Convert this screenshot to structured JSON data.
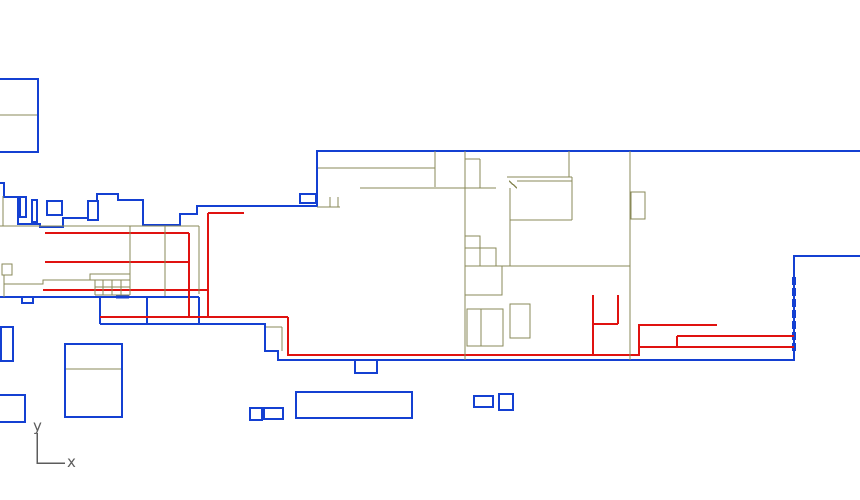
{
  "canvas": {
    "width": 860,
    "height": 500,
    "background": "#ffffff"
  },
  "colors": {
    "blue": "#1440d2",
    "red": "#e01210",
    "olive": "#8a8a58",
    "axis": "#5c5c5c"
  },
  "axis_indicator": {
    "y_label": "y",
    "x_label": "x",
    "origin": [
      37,
      463
    ],
    "y_top": 433,
    "x_right": 65
  },
  "stroke_widths": {
    "blue": 1.8,
    "red": 1.6,
    "olive": 1.4,
    "axis": 1.5
  },
  "shapes": [
    {
      "layer": "blue",
      "type": "rect",
      "x": -2,
      "y": 79,
      "w": 40,
      "h": 73
    },
    {
      "layer": "olive",
      "type": "seg",
      "p": [
        0,
        115,
        38,
        115
      ]
    },
    {
      "layer": "blue",
      "type": "poly",
      "pts": [
        [
          0,
          183
        ],
        [
          4,
          183
        ],
        [
          4,
          197
        ],
        [
          18,
          197
        ],
        [
          18,
          224
        ],
        [
          40,
          224
        ],
        [
          40,
          227
        ],
        [
          63,
          227
        ],
        [
          63,
          218
        ],
        [
          88,
          218
        ],
        [
          88,
          201
        ],
        [
          97,
          201
        ],
        [
          97,
          194
        ],
        [
          118,
          194
        ],
        [
          118,
          200
        ],
        [
          143,
          200
        ],
        [
          143,
          225
        ],
        [
          180,
          225
        ],
        [
          180,
          214
        ],
        [
          197,
          214
        ],
        [
          197,
          206
        ],
        [
          317,
          206
        ],
        [
          317,
          151
        ],
        [
          860,
          151
        ]
      ]
    },
    {
      "layer": "blue",
      "type": "rect",
      "x": 20,
      "y": 197,
      "w": 6,
      "h": 20
    },
    {
      "layer": "blue",
      "type": "rect",
      "x": 32,
      "y": 200,
      "w": 5,
      "h": 22
    },
    {
      "layer": "blue",
      "type": "rect",
      "x": 47,
      "y": 201,
      "w": 15,
      "h": 14
    },
    {
      "layer": "blue",
      "type": "rect",
      "x": 88,
      "y": 201,
      "w": 10,
      "h": 19
    },
    {
      "layer": "blue",
      "type": "rect",
      "x": 300,
      "y": 194,
      "w": 16,
      "h": 9
    },
    {
      "layer": "blue",
      "type": "seg",
      "p": [
        0,
        297,
        199,
        297
      ]
    },
    {
      "layer": "blue",
      "type": "seg",
      "p": [
        199,
        297,
        199,
        324
      ]
    },
    {
      "layer": "blue",
      "type": "seg",
      "p": [
        100,
        297,
        100,
        324
      ]
    },
    {
      "layer": "blue",
      "type": "seg",
      "p": [
        147,
        297,
        147,
        324
      ]
    },
    {
      "layer": "blue",
      "type": "poly",
      "pts": [
        [
          100,
          324
        ],
        [
          265,
          324
        ],
        [
          265,
          351
        ],
        [
          278,
          351
        ],
        [
          278,
          360
        ],
        [
          794,
          360
        ],
        [
          794,
          256
        ],
        [
          860,
          256
        ]
      ]
    },
    {
      "layer": "blue",
      "type": "poly",
      "pts": [
        [
          355,
          360
        ],
        [
          355,
          373
        ],
        [
          377,
          373
        ],
        [
          377,
          360
        ]
      ]
    },
    {
      "layer": "blue",
      "type": "poly",
      "pts": [
        [
          22,
          297
        ],
        [
          22,
          303
        ],
        [
          33,
          303
        ],
        [
          33,
          297
        ]
      ]
    },
    {
      "layer": "blue",
      "type": "seg",
      "p": [
        116,
        297,
        129,
        297
      ],
      "w": 3
    },
    {
      "layer": "blue",
      "type": "seg",
      "p": [
        794,
        277,
        794,
        353
      ],
      "w": 4,
      "dash": "8,3"
    },
    {
      "layer": "blue",
      "type": "rect",
      "x": 1,
      "y": 327,
      "w": 12,
      "h": 34
    },
    {
      "layer": "blue",
      "type": "rect",
      "x": 65,
      "y": 344,
      "w": 57,
      "h": 73
    },
    {
      "layer": "olive",
      "type": "seg",
      "p": [
        65,
        369,
        122,
        369
      ]
    },
    {
      "layer": "blue",
      "type": "rect",
      "x": -3,
      "y": 395,
      "w": 28,
      "h": 27
    },
    {
      "layer": "blue",
      "type": "rect",
      "x": 250,
      "y": 408,
      "w": 12,
      "h": 12
    },
    {
      "layer": "blue",
      "type": "rect",
      "x": 264,
      "y": 408,
      "w": 19,
      "h": 11
    },
    {
      "layer": "blue",
      "type": "rect",
      "x": 296,
      "y": 392,
      "w": 116,
      "h": 26
    },
    {
      "layer": "blue",
      "type": "rect",
      "x": 474,
      "y": 396,
      "w": 19,
      "h": 11
    },
    {
      "layer": "blue",
      "type": "rect",
      "x": 499,
      "y": 394,
      "w": 14,
      "h": 16
    },
    {
      "layer": "red",
      "type": "seg",
      "p": [
        45,
        233,
        189,
        233
      ]
    },
    {
      "layer": "red",
      "type": "seg",
      "p": [
        45,
        262,
        189,
        262
      ]
    },
    {
      "layer": "red",
      "type": "seg",
      "p": [
        43,
        290,
        208,
        290
      ]
    },
    {
      "layer": "red",
      "type": "seg",
      "p": [
        100,
        317,
        288,
        317
      ]
    },
    {
      "layer": "red",
      "type": "seg",
      "p": [
        189,
        233,
        189,
        317
      ]
    },
    {
      "layer": "red",
      "type": "seg",
      "p": [
        208,
        213,
        208,
        317
      ]
    },
    {
      "layer": "red",
      "type": "seg",
      "p": [
        208,
        213,
        244,
        213
      ]
    },
    {
      "layer": "red",
      "type": "poly",
      "pts": [
        [
          288,
          317
        ],
        [
          288,
          355
        ],
        [
          639,
          355
        ],
        [
          639,
          325
        ],
        [
          717,
          325
        ]
      ]
    },
    {
      "layer": "red",
      "type": "seg",
      "p": [
        639,
        347,
        794,
        347
      ]
    },
    {
      "layer": "red",
      "type": "seg",
      "p": [
        677,
        336,
        794,
        336
      ]
    },
    {
      "layer": "red",
      "type": "seg",
      "p": [
        677,
        336,
        677,
        347
      ]
    },
    {
      "layer": "red",
      "type": "seg",
      "p": [
        593,
        295,
        593,
        355
      ]
    },
    {
      "layer": "red",
      "type": "seg",
      "p": [
        618,
        295,
        618,
        324
      ]
    },
    {
      "layer": "red",
      "type": "seg",
      "p": [
        593,
        324,
        618,
        324
      ]
    },
    {
      "layer": "olive",
      "type": "seg",
      "p": [
        3,
        196,
        3,
        226
      ]
    },
    {
      "layer": "olive",
      "type": "seg",
      "p": [
        0,
        226,
        199,
        226
      ]
    },
    {
      "layer": "olive",
      "type": "seg",
      "p": [
        130,
        226,
        130,
        295
      ]
    },
    {
      "layer": "olive",
      "type": "seg",
      "p": [
        165,
        226,
        165,
        296
      ]
    },
    {
      "layer": "olive",
      "type": "seg",
      "p": [
        199,
        226,
        199,
        294
      ]
    },
    {
      "layer": "olive",
      "type": "seg",
      "p": [
        317,
        207,
        340,
        207
      ]
    },
    {
      "layer": "olive",
      "type": "seg",
      "p": [
        330,
        197,
        330,
        207
      ]
    },
    {
      "layer": "olive",
      "type": "seg",
      "p": [
        338,
        197,
        338,
        207
      ]
    },
    {
      "layer": "olive",
      "type": "seg",
      "p": [
        318,
        168,
        435,
        168
      ]
    },
    {
      "layer": "olive",
      "type": "seg",
      "p": [
        435,
        151,
        435,
        187
      ]
    },
    {
      "layer": "olive",
      "type": "seg",
      "p": [
        360,
        188,
        496,
        188
      ]
    },
    {
      "layer": "olive",
      "type": "seg",
      "p": [
        465,
        151,
        465,
        360
      ]
    },
    {
      "layer": "olive",
      "type": "seg",
      "p": [
        465,
        159,
        480,
        159
      ]
    },
    {
      "layer": "olive",
      "type": "seg",
      "p": [
        480,
        159,
        480,
        188
      ]
    },
    {
      "layer": "olive",
      "type": "seg",
      "p": [
        569,
        151,
        569,
        177
      ]
    },
    {
      "layer": "olive",
      "type": "seg",
      "p": [
        507,
        177,
        572,
        177
      ]
    },
    {
      "layer": "olive",
      "type": "seg",
      "p": [
        509,
        181,
        517,
        188
      ]
    },
    {
      "layer": "olive",
      "type": "seg",
      "p": [
        517,
        181,
        572,
        181
      ]
    },
    {
      "layer": "olive",
      "type": "seg",
      "p": [
        510,
        188,
        510,
        266
      ]
    },
    {
      "layer": "olive",
      "type": "seg",
      "p": [
        510,
        220,
        572,
        220
      ]
    },
    {
      "layer": "olive",
      "type": "seg",
      "p": [
        572,
        177,
        572,
        220
      ]
    },
    {
      "layer": "olive",
      "type": "seg",
      "p": [
        630,
        151,
        630,
        360
      ]
    },
    {
      "layer": "olive",
      "type": "seg",
      "p": [
        465,
        266,
        630,
        266
      ]
    },
    {
      "layer": "olive",
      "type": "rect",
      "x": 631,
      "y": 192,
      "w": 14,
      "h": 27
    },
    {
      "layer": "olive",
      "type": "rect",
      "x": 465,
      "y": 236,
      "w": 15,
      "h": 12
    },
    {
      "layer": "olive",
      "type": "rect",
      "x": 480,
      "y": 248,
      "w": 16,
      "h": 18
    },
    {
      "layer": "olive",
      "type": "rect",
      "x": 465,
      "y": 266,
      "w": 37,
      "h": 29
    },
    {
      "layer": "olive",
      "type": "rect",
      "x": 467,
      "y": 309,
      "w": 14,
      "h": 37
    },
    {
      "layer": "olive",
      "type": "rect",
      "x": 481,
      "y": 309,
      "w": 22,
      "h": 37
    },
    {
      "layer": "olive",
      "type": "rect",
      "x": 510,
      "y": 304,
      "w": 20,
      "h": 34
    },
    {
      "layer": "olive",
      "type": "seg",
      "p": [
        266,
        327,
        282,
        327
      ]
    },
    {
      "layer": "olive",
      "type": "seg",
      "p": [
        282,
        327,
        282,
        351
      ]
    },
    {
      "layer": "olive",
      "type": "rect",
      "x": 2,
      "y": 264,
      "w": 10,
      "h": 11
    },
    {
      "layer": "olive",
      "type": "seg",
      "p": [
        4,
        275,
        4,
        297
      ]
    },
    {
      "layer": "olive",
      "type": "poly",
      "pts": [
        [
          4,
          284
        ],
        [
          43,
          284
        ],
        [
          43,
          280
        ],
        [
          90,
          280
        ],
        [
          90,
          274
        ],
        [
          130,
          274
        ]
      ]
    },
    {
      "layer": "olive",
      "type": "seg",
      "p": [
        90,
        280,
        130,
        280
      ]
    },
    {
      "layer": "olive",
      "type": "seg",
      "p": [
        95,
        287,
        130,
        287
      ]
    },
    {
      "layer": "olive",
      "type": "seg",
      "p": [
        95,
        295,
        130,
        295
      ]
    },
    {
      "layer": "olive",
      "type": "seg",
      "p": [
        95,
        280,
        95,
        295
      ]
    },
    {
      "layer": "olive",
      "type": "seg",
      "p": [
        103,
        280,
        103,
        295
      ]
    },
    {
      "layer": "olive",
      "type": "seg",
      "p": [
        112,
        280,
        112,
        295
      ]
    },
    {
      "layer": "olive",
      "type": "seg",
      "p": [
        121,
        280,
        121,
        295
      ]
    }
  ]
}
